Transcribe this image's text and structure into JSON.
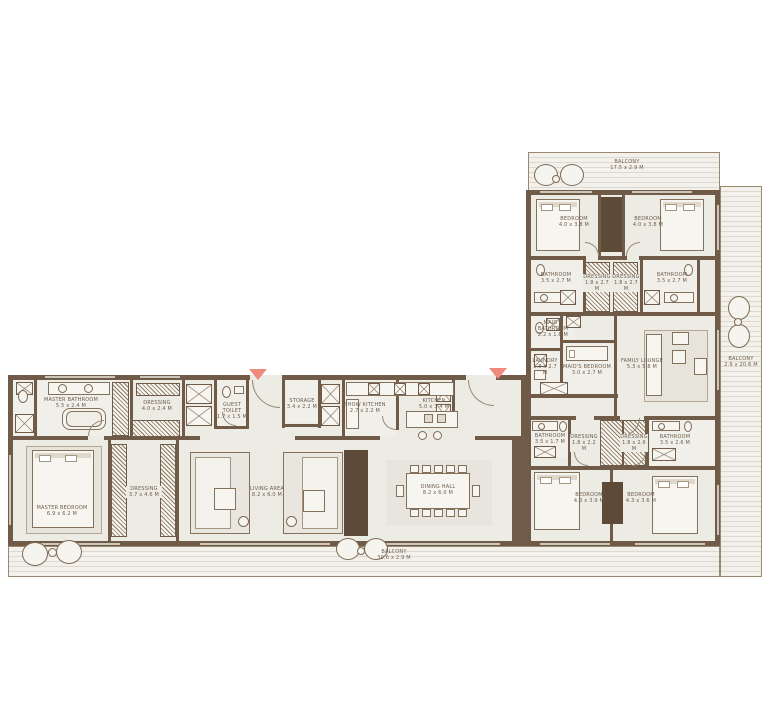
{
  "colors": {
    "wall": "#6f5b48",
    "floor": "#ecebe4",
    "balcony_line": "#ddd9d0",
    "entry_marker": "#ef8a7c"
  },
  "rooms": {
    "balcony_top": {
      "name": "BALCONY",
      "dims": "17.5 x 2.9 M"
    },
    "balcony_right": {
      "name": "BALCONY",
      "dims": "2.9 x 20.6 M"
    },
    "balcony_bottom": {
      "name": "BALCONY",
      "dims": "30.6 x 2.9 M"
    },
    "bedroom_2": {
      "name": "BEDROOM",
      "dims": "4.0 x 3.8 M"
    },
    "bedroom_3": {
      "name": "BEDROOM",
      "dims": "4.0 x 3.8 M"
    },
    "bathroom_2": {
      "name": "BATHROOM",
      "dims": "3.5 x 2.7 M"
    },
    "dressing_2": {
      "name": "DRESSING",
      "dims": "1.8 x 2.7 M"
    },
    "dressing_3": {
      "name": "DRESSING",
      "dims": "1.8 x 2.7 M"
    },
    "bathroom_3": {
      "name": "BATHROOM",
      "dims": "3.5 x 2.7 M"
    },
    "maids_bathroom": {
      "name": "MAID'S BATHROOM",
      "dims": "2.2 x 1.6 M"
    },
    "laundry": {
      "name": "LAUNDRY",
      "dims": "1.8 x 2.7 M"
    },
    "maids_bedroom": {
      "name": "MAID'S BEDROOM",
      "dims": "3.0 x 2.7 M"
    },
    "family_lounge": {
      "name": "FAMILY LOUNGE",
      "dims": "5.3 x 5.8 M"
    },
    "bathroom_4": {
      "name": "BATHROOM",
      "dims": "3.5 x 1.7 M"
    },
    "dressing_4": {
      "name": "DRESSING",
      "dims": "1.8 x 2.2 M"
    },
    "dressing_5": {
      "name": "DRESSING",
      "dims": "1.8 x 2.6 M"
    },
    "bathroom_5": {
      "name": "BATHROOM",
      "dims": "3.5 x 2.6 M"
    },
    "bedroom_4": {
      "name": "BEDROOM",
      "dims": "4.3 x 3.9 M"
    },
    "bedroom_5": {
      "name": "BEDROOM",
      "dims": "4.3 x 3.6 M"
    },
    "master_bathroom": {
      "name": "MASTER BATHROOM",
      "dims": "5.5 x 2.4 M"
    },
    "dressing_master": {
      "name": "DRESSING",
      "dims": "4.0 x 2.4 M"
    },
    "master_bedroom": {
      "name": "MASTER BEDROOM",
      "dims": "6.9 x 6.2 M"
    },
    "dressing_master2": {
      "name": "DRESSING",
      "dims": "3.7 x 4.6 M"
    },
    "guest_toilet": {
      "name": "GUEST TOILET",
      "dims": "1.7 x 1.5 M"
    },
    "storage": {
      "name": "STORAGE",
      "dims": "3.4 x 2.2 M"
    },
    "show_kitchen": {
      "name": "SHOW KITCHEN",
      "dims": "2.7 x 2.2 M"
    },
    "kitchen": {
      "name": "KITCHEN",
      "dims": "5.0 x 3.4 M"
    },
    "living_area": {
      "name": "LIVING AREA",
      "dims": "8.2 x 6.0 M"
    },
    "dining_hall": {
      "name": "DINING HALL",
      "dims": "8.2 x 6.0 M"
    }
  }
}
